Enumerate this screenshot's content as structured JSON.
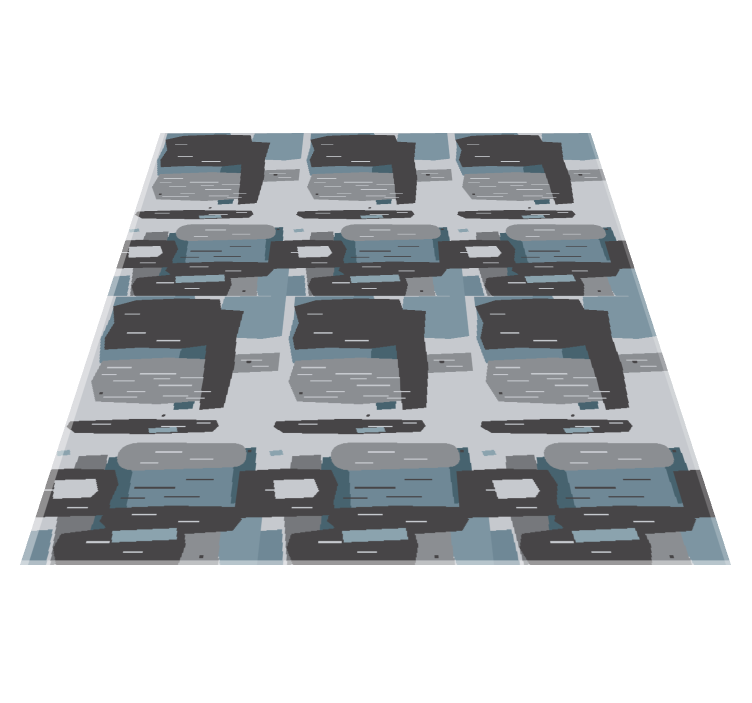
{
  "scene": {
    "background_color": "#ffffff",
    "canvas": {
      "width": 752,
      "height": 703
    },
    "description": "Perspective product render of a rectangular area rug lying on a white background, viewed from a low front angle"
  },
  "rug": {
    "style": "abstract hand-painted brush-stroke pattern",
    "geometry": {
      "top_width_px": 430,
      "bottom_width_px": 711,
      "visible_height_px": 432,
      "top_left": [
        162,
        133
      ],
      "top_right": [
        592,
        133
      ],
      "bottom_left": [
        20,
        565
      ],
      "bottom_right": [
        731,
        565
      ]
    },
    "pattern": {
      "repeat_columns": 3,
      "repeat_rows": 2,
      "tile_width": 237,
      "tile_height": 466,
      "elements": [
        "chunky charcoal horizontal bars",
        "dark charcoal vertical columns",
        "thin torn charcoal bars",
        "speckled medium-gray brush patches",
        "rounded medium-gray brush stroke",
        "large slate-blue square patches",
        "charcoal ring with light opening",
        "dark teal vertical strips",
        "dark gray vertical strokes",
        "pale slate accent dashes"
      ]
    },
    "palette": {
      "bg": "#c6c9ce",
      "slate": "#6f8896",
      "slate_light": "#7d95a2",
      "slate_pale": "#8ba3ae",
      "gray": "#8b8e92",
      "gray_dark": "#76787c",
      "charcoal": "#474547",
      "teal": "#47636f"
    },
    "edge_highlight": "soft white sheen along left, right and bottom edges"
  }
}
